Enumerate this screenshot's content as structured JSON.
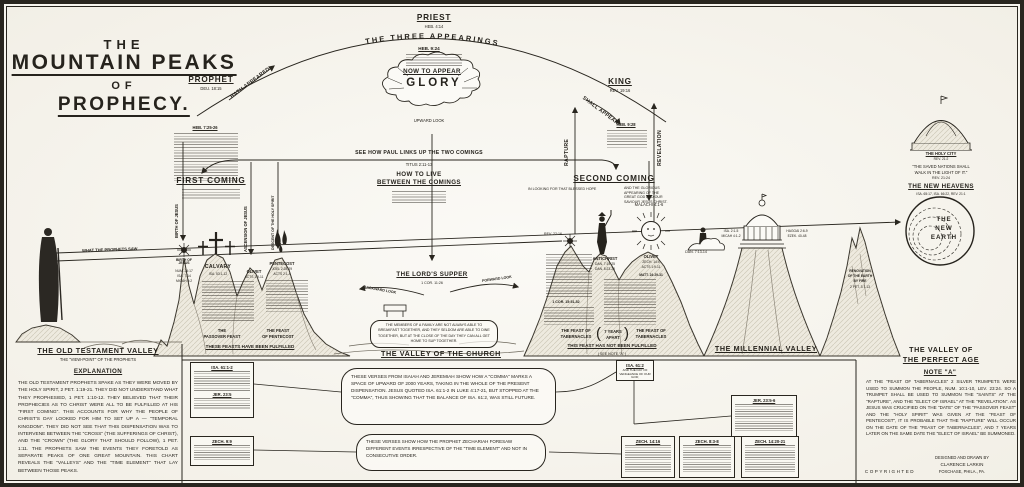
{
  "ink": "#26231d",
  "title": {
    "l1": "THE",
    "l2": "MOUNTAIN PEAKS",
    "l3": "OF",
    "l4": "PROPHECY."
  },
  "top": {
    "priest": "PRIEST",
    "priest_ref": "HEB. 4:14",
    "arc": "THE THREE APPEARINGS",
    "heb924": "HEB. 9:24",
    "now_to_appear": "NOW TO APPEAR",
    "glory": "GLORY",
    "upward_look": "UPWARD LOOK",
    "prophet": "PROPHET",
    "prophet_ref": "DEU. 18:15",
    "hath_appeared": "HATH APPEARED",
    "heb725": "HEB. 7:25-26",
    "king": "KING",
    "king_ref": "REV. 19:16",
    "shall_appear": "SHALL APPEAR",
    "heb928": "HEB. 9:28"
  },
  "link": {
    "see_how": "SEE HOW PAUL LINKS UP THE TWO COMINGS",
    "titus": "TITUS 2:11-13",
    "how1": "HOW TO LIVE",
    "how2": "BETWEEN THE COMINGS"
  },
  "comings": {
    "first": "FIRST COMING",
    "second": "SECOND COMING",
    "second_left": "IN LOOKING FOR THAT BLESSED HOPE",
    "second_right": "AND THE GLORIOUS APPEARING OF THE GREAT GOD AND OUR SAVIOUR JESUS CHRIST.",
    "birth": "BIRTH OF JESUS",
    "ascension": "ASCENSION OF JESUS",
    "descent": "DESCENT OF THE HOLY SPIRIT",
    "rapture": "RAPTURE",
    "revelation": "REVELATION",
    "malachi": "MALACHI 4:1-6",
    "dan713": "DAN. 7:13-14",
    "rev2216": "REV. 22:16"
  },
  "sightline": {
    "label": "WHAT THE PROPHETS SAW"
  },
  "peaks": {
    "birth": {
      "name": "BIRTH OF JESUS",
      "refs": [
        "NUM. 24:17",
        "ISA. 7:14",
        "MICAH 5:2"
      ]
    },
    "calvary": {
      "name": "CALVARY",
      "ref": "ISA. 53:1-12"
    },
    "olivet1": {
      "name": "OLIVET",
      "ref": "ACTS 1:9-11"
    },
    "pentecost": {
      "name": "PENTECOST",
      "refs": [
        "JOEL 2:28-29",
        "ACTS 2:1-4"
      ]
    },
    "antichrist": {
      "name": "ANTICHRIST",
      "refs": [
        "DAN. 7:19-25",
        "DAN. 8:23-25"
      ]
    },
    "olivet2": {
      "name": "OLIVET",
      "refs": [
        "ZECH. 14:4",
        "ACTS 1:9-11",
        "MATT. 24:29-31"
      ]
    },
    "cor": "1 COR. 15:51-52"
  },
  "supper": {
    "title": "THE LORD'S SUPPER",
    "ref": "1 COR. 11:26",
    "backward": "BACKWARD LOOK",
    "forward": "FORWARD LOOK",
    "box": "THE MEMBERS OF A FAMILY ARE NOT ALWAYS ABLE TO BREAKFAST TOGETHER, AND THEY SELDOM ARE ABLE TO DINE TOGETHER, BUT AT THE CLOSE OF THE DAY THEY CAN ALL GET HOME TO SUP TOGETHER."
  },
  "feasts": {
    "pass1": "THE",
    "pass2": "PASSOVER FEAST",
    "pent1": "THE FEAST",
    "pent2": "OF PENTECOST",
    "fulfilled": "THESE FEASTS HAVE BEEN FULFILLED",
    "tab1a": "THE FEAST OF",
    "tab1b": "TABERNACLES",
    "tab2a": "THE FEAST OF",
    "tab2b": "TABERNACLES",
    "years1": "7 YEARS",
    "years2": "APART",
    "paren_l": "(",
    "paren_r": ")",
    "not_fulfilled": "THIS FEAST HAS NOT BEEN FULFILLED",
    "see_note": "( SEE NOTE \"A\" )"
  },
  "millennial": {
    "tl1": "ISA. 2:1-5",
    "tl2": "MICAH 4:1-2",
    "tr1": "HAGGAI 2:6-9",
    "tr2": "EZEK. 40-48",
    "ren1": "RENOVATION",
    "ren2": "OF THE EARTH",
    "ren3": "BY FIRE",
    "ren_ref": "2 PET. 3:7-13"
  },
  "right": {
    "holy_city": "THE HOLY CITY",
    "holy_city_ref": "REV. 21:2",
    "q1": "\"THE SAVED NATIONS SHALL",
    "q2": "WALK IN THE LIGHT OF IT.\"",
    "q_ref": "REV. 21:24",
    "new_heavens": "THE NEW HEAVENS",
    "nh_refs": "ISA. 65:17, ISA. 66:22, REV. 21:1",
    "ne1": "THE",
    "ne2": "NEW",
    "ne3": "EARTH"
  },
  "valleys": {
    "ot": "THE OLD TESTAMENT VALLEY",
    "ot_sub": "THE \"VIEW-POINT\" OF THE PROPHETS",
    "church": "THE VALLEY OF THE CHURCH",
    "mill": "THE MILLENNIAL VALLEY",
    "perfect1": "THE VALLEY OF",
    "perfect2": "THE PERFECT AGE"
  },
  "explanation": {
    "title": "EXPLANATION",
    "body": "THE OLD TESTAMENT PROPHETS SPAKE AS THEY WERE MOVED BY THE HOLY SPIRIT, 2 PET. 1:19-21. THEY DID NOT UNDERSTAND WHAT THEY PROPHESIED, 1 PET. 1:10-12. THEY BELIEVED THAT THEIR PROPHECIES AS TO CHRIST WERE ALL TO BE FULFILLED AT HIS \"FIRST COMING\". THIS ACCOUNTS FOR WHY THE PEOPLE OF CHRIST'S DAY LOOKED FOR HIM TO SET UP A — \"TEMPORAL KINGDOM\". THEY DID NOT SEE THAT THIS DISPENSATION WAS TO INTERVENE BETWEEN THE \"CROSS\" (THE SUFFERINGS OF CHRIST), AND THE \"CROWN\" (THE GLORY THAT SHOULD FOLLOW), 1 PET. 1:11. THE PROPHETS SAW THE EVENTS THEY FORETOLD AS SEPARATE PEAKS OF ONE GREAT MOUNTAIN. THIS CHART REVEALS THE \"VALLEYS\" AND THE \"TIME ELEMENT\" THAT LAY BETWEEN THOSE PEAKS."
  },
  "note_a": {
    "title": "NOTE \"A\"",
    "body": "AT THE \"FEAST OF TABERNACLES\" 2 SILVER TRUMPETS WERE USED TO SUMMON THE PEOPLE, NUM. 10:1-10, LEV. 23:24. SO A TRUMPET SHALL BE USED TO SUMMON THE \"SAINTS\" AT THE \"RAPTURE\", AND THE \"ELECT OF ISRAEL\" AT THE \"REVELATION\". AS JESUS WAS CRUCIFIED ON THE \"DATE\" OF THE \"PASSOVER FEAST\" AND THE \"HOLY SPIRIT\" WAS GIVEN AT THE \"FEAST OF PENTECOST\", IT IS PROBABLE THAT THE \"RAPTURE\" WILL OCCUR ON THE DATE OF THE \"FEAST OF TABERNACLES\", AND 7 YEARS LATER ON THE SAME DATE THE \"ELECT OF ISRAEL\" BE SUMMONED."
  },
  "bubbles": {
    "b1": "THESE VERSES FROM ISAIAH AND JEREMIAH SHOW HOW A \"COMMA\" MARKS A SPACE OF UPWARD OF 2000 YEARS, TAKING IN THE WHOLE OF THE PRESENT DISPENSATION. JESUS QUOTED ISA. 61:1-2 IN LUKE 4:17-21, BUT STOPPED AT THE \"COMMA\", THUS SHOWING THAT THE BALANCE OF ISA. 61:2, WAS STILL FUTURE.",
    "b2": "THESE VERSES SHOW HOW THE PROPHET ZECHARIAH FORESAW DIFFERENT EVENTS IRRESPECTIVE OF THE \"TIME ELEMENT\" AND NOT IN CONSECUTIVE ORDER."
  },
  "boxes": {
    "isa6112": "ISA. 61:1-2",
    "jer235": "JER. 23:5",
    "zech99": "ZECH. 9:9",
    "isa612": "ISA. 61:2",
    "isa612_line": "AND THE DAY OF VENGEANCE OF OUR GOD;",
    "jer2356": "JER. 23:5-6",
    "zech1416": "ZECH. 14:16",
    "zech838": "ZECH. 8:3-8",
    "zech1420": "ZECH. 14:20-21"
  },
  "credits": {
    "l1": "DESIGNED AND DRAWN BY",
    "l2": "CLARENCE LARKIN",
    "l3": "FOXCHASE, PHILA., PA.",
    "copyright": "COPYRIGHTED"
  }
}
